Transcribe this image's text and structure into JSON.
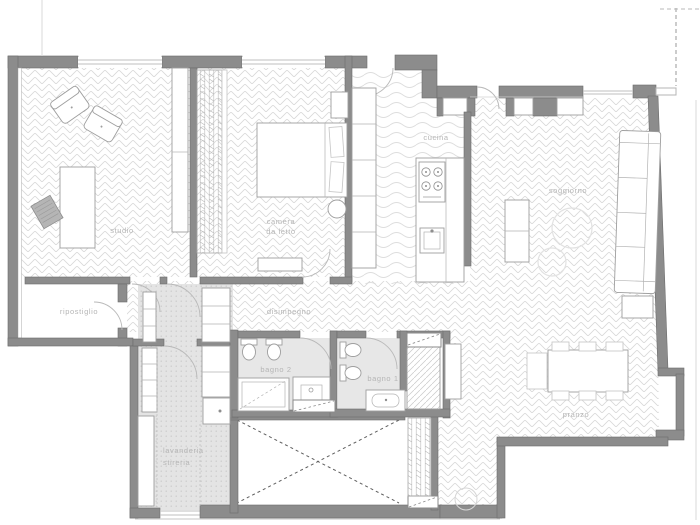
{
  "plan": {
    "type": "apartment-floor-plan",
    "rooms": {
      "studio": {
        "label": "studio"
      },
      "camera": {
        "line1": "camera",
        "line2": "da letto"
      },
      "cucina": {
        "label": "cucina"
      },
      "soggiorno": {
        "label": "soggiorno"
      },
      "ripostiglio": {
        "label": "ripostiglio"
      },
      "disimpegno": {
        "label": "disimpegno"
      },
      "bagno2": {
        "label": "bagno 2"
      },
      "bagno1": {
        "label": "bagno 1"
      },
      "lavanderia": {
        "line1": "lavanderia",
        "line2": "stireria"
      },
      "pranzo": {
        "label": "pranzo"
      }
    },
    "colors": {
      "wall": "#8c8c8c",
      "wall_outline": "#6d6d6d",
      "floor_pattern_line": "#d8d8d8",
      "bath_floor": "#e7e7e7",
      "laundry_floor": "#e4e4e4",
      "label_text": "#b5b5b5",
      "furniture_outline": "#9e9e9e",
      "void_dash": "#5f5f5f",
      "background": "#ffffff"
    }
  }
}
